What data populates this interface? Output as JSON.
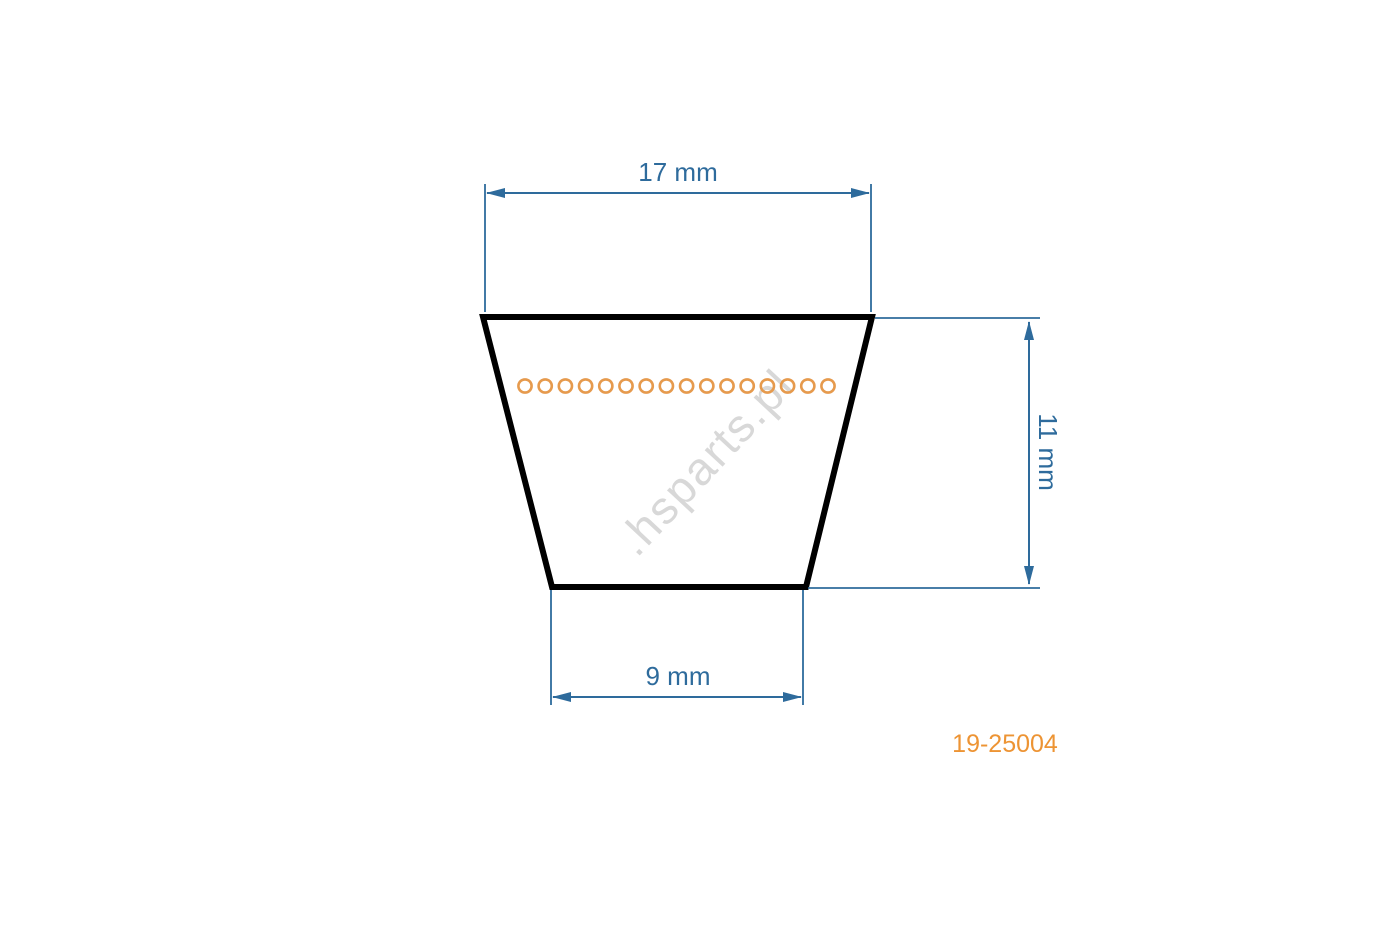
{
  "diagram": {
    "type": "v-belt-cross-section-technical-drawing",
    "labels": {
      "top_width": "17 mm",
      "height": "11 mm",
      "bottom_width": "9 mm"
    },
    "dimensions_mm": {
      "top_width": 17,
      "height": 11,
      "bottom_width": 9
    },
    "part_number": "19-25004",
    "watermark": ".hsparts.pl",
    "cord_line": {
      "circle_count": 16,
      "start_x": 525,
      "end_x": 828,
      "center_y": 386,
      "radius": 6.6
    },
    "colors": {
      "dimension_blue": "#2e6b9c",
      "outline_black": "#000000",
      "cord_orange": "#e69a4d",
      "part_number_orange": "#ed9434",
      "watermark_gray": "#d8d8d8",
      "background": "#ffffff"
    }
  }
}
